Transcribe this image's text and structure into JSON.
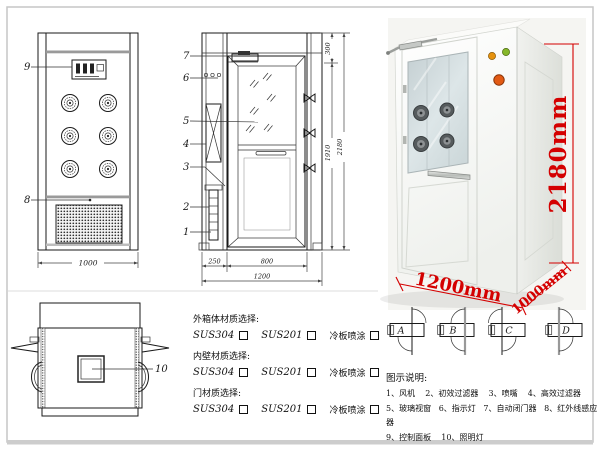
{
  "front_view": {
    "callout_control_panel": "9",
    "callout_infrared_sensor": "8",
    "dim_width": "1000"
  },
  "side_view": {
    "callout_fan": "1",
    "callout_primary_filter": "2",
    "callout_nozzle": "3",
    "callout_hepa_filter": "4",
    "callout_glass_window": "5",
    "callout_indicator_light": "6",
    "callout_door_closer": "7",
    "dim_top": "300",
    "dim_door_height": "1910",
    "dim_total_height": "2180",
    "dim_back_depth": "250",
    "dim_door_width": "800",
    "dim_total_width": "1200"
  },
  "top_view": {
    "callout_lamp": "10"
  },
  "photo_dims": {
    "height": "2180mm",
    "width": "1200mm",
    "depth": "1000mm"
  },
  "door_configs": {
    "a": "A",
    "b": "B",
    "c": "C",
    "d": "D"
  },
  "materials": {
    "sections": [
      {
        "title": "外箱体材质选择:",
        "opt1": "SUS304",
        "opt2": "SUS201",
        "opt3": "冷板喷涂"
      },
      {
        "title": "内壁材质选择:",
        "opt1": "SUS304",
        "opt2": "SUS201",
        "opt3": "冷板喷涂"
      },
      {
        "title": "门材质选择:",
        "opt1": "SUS304",
        "opt2": "SUS201",
        "opt3": "冷板喷涂"
      }
    ]
  },
  "legend": {
    "title": "图示说明:",
    "rows": [
      "1、风机    2、初效过滤器    3、喷嘴    4、高效过滤器",
      "5、玻璃视窗   6、指示灯   7、自动闭门器   8、红外线感应器",
      "9、控制面板    10、照明灯"
    ]
  },
  "colors": {
    "annotation_red": "#d40000",
    "indicator_orange": "#e6920f",
    "indicator_green": "#86b72a",
    "emergency_button": "#e25a14",
    "line_dark": "#1a1a1a"
  }
}
